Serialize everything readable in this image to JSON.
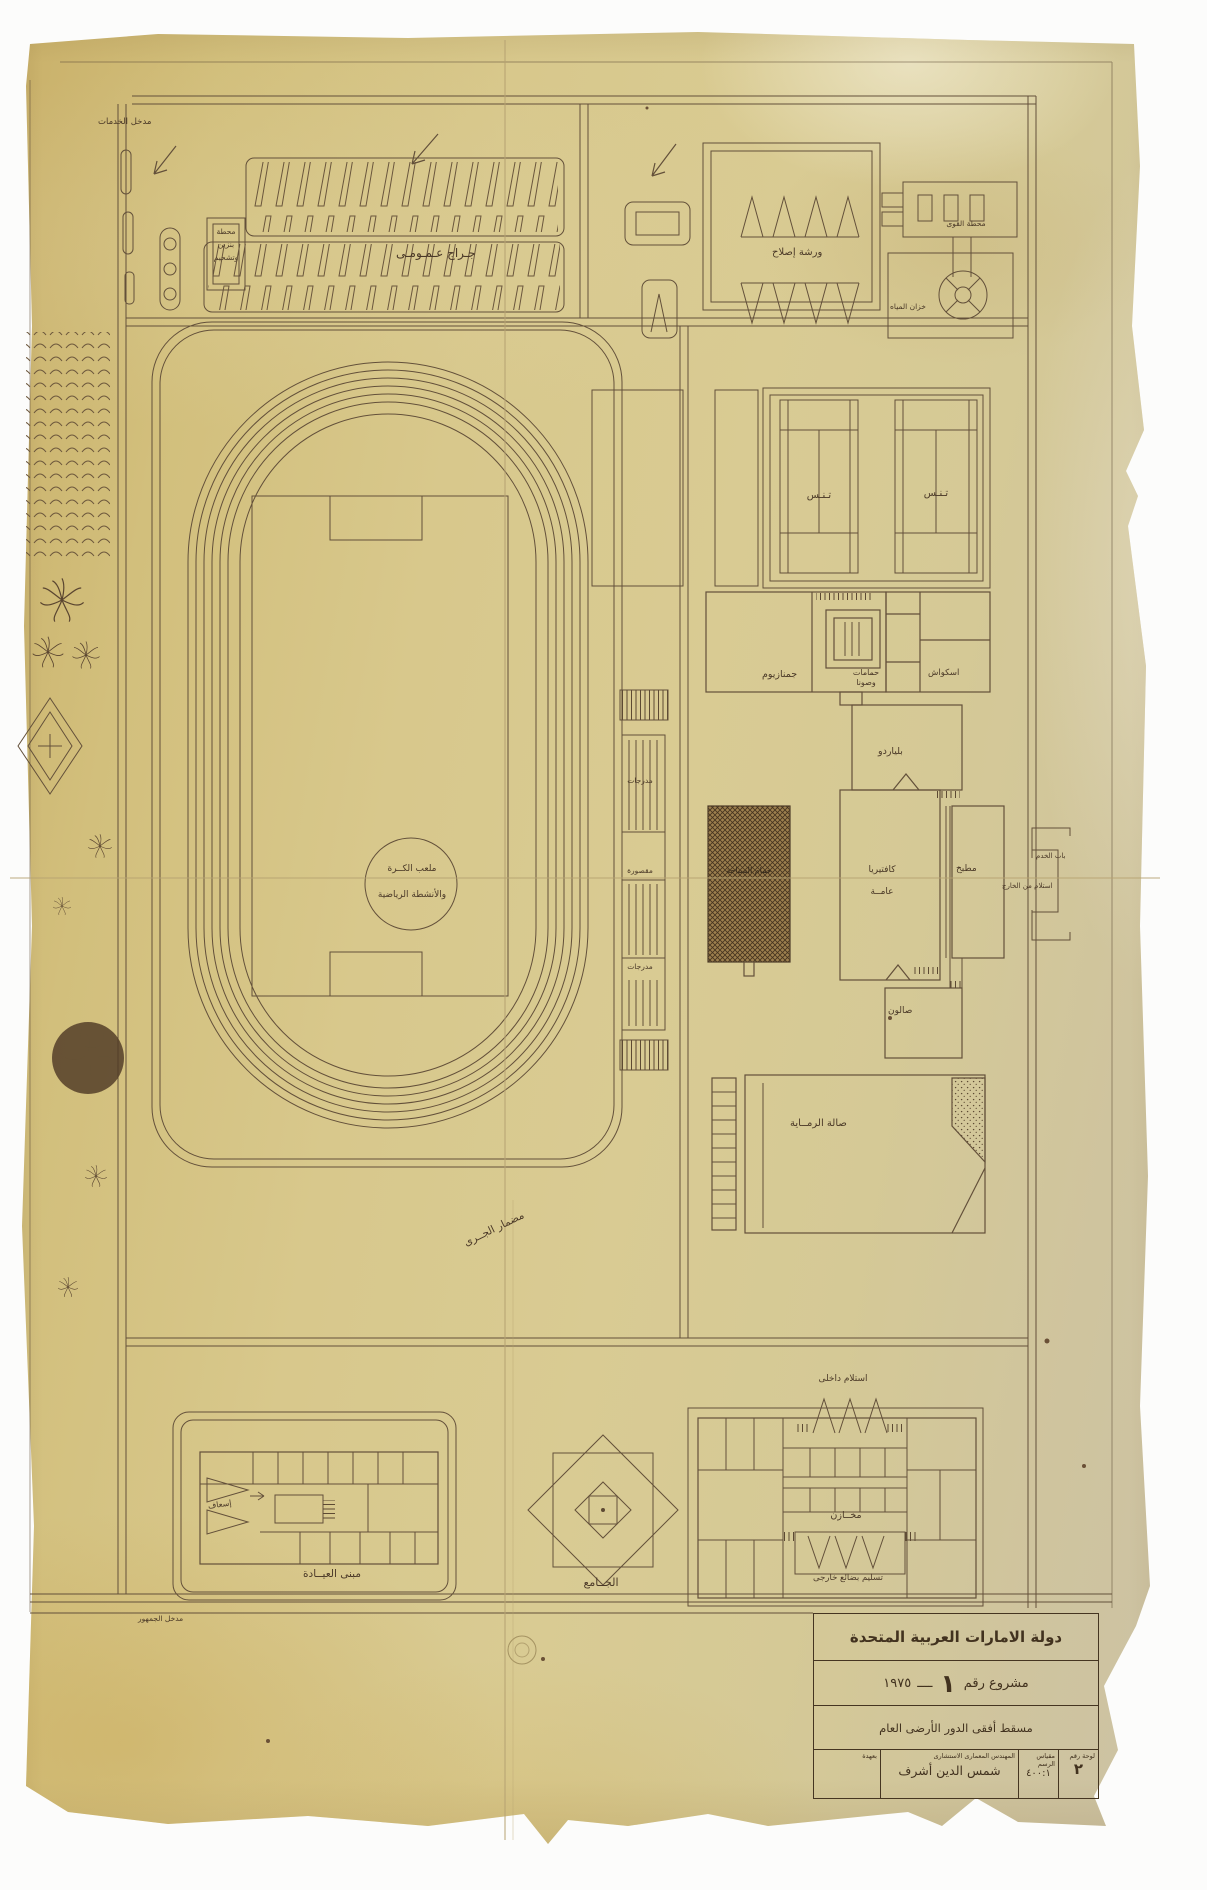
{
  "labels": {
    "service_entrance": "مدخل الخدمات",
    "gas_station": "محطة\nبنزين\nوتشحيم",
    "public_garage": "جـراج عـمـومـى",
    "repair_workshop": "ورشة إصلاح",
    "power_station": "محطة القوى",
    "water_tank": "خزان المياه",
    "tennis_court_1": "تـنـس",
    "tennis_court_2": "تـنـس",
    "gymnasium": "جمنازيوم",
    "baths_sauna": "حمامات\nوصونا",
    "squash": "اسكواش",
    "billiards": "بلياردو",
    "swimming_pool": "حمام السباحة",
    "cafeteria": "كافتيريا\nعامــة",
    "kitchen": "مطبخ",
    "service_gate": "باب الخدم",
    "receiving_outside": "استلام من الخارج",
    "salon": "صالون",
    "shooting_hall": "صالة الرمــاية",
    "stands_top": "مدرجات",
    "royal_box": "مقصورة",
    "stands_bottom": "مدرجات",
    "pitch_circle": "ملعب الكــرة\nوالأنشطة الرياضية",
    "running_track": "مضمار الجــرى",
    "clinic_building": "مبنى العيــادة",
    "ambulance": "إسعاف",
    "public_entrance": "مدخل الجمهور",
    "mosque": "الجــامع",
    "receiving_internal": "استلام داخلى",
    "warehouses": "مخــازن",
    "external_delivery": "تسليم بضائع خارجى"
  },
  "title_block": {
    "country": "دولة الامارات العربية المتحدة",
    "project_prefix": "مشروع رقم",
    "project_number": "١",
    "separator": "ــــ",
    "project_year": "١٩٧٥",
    "drawing_title": "مسقط أفقى الدور الأرضى العام",
    "custody_label": "بعهدة",
    "architect_title": "المهندس المعمارى الاستشارى",
    "architect_name": "شمس الدين أشرف",
    "scale_label": "مقياس الرسم",
    "scale_value": "٤٠٠:١",
    "sheet_label": "لوحة رقم",
    "sheet_value": "٢"
  },
  "colors": {
    "paper": "#d6c58c",
    "ink": "#5d4a33",
    "ink_dark": "#3f301f"
  }
}
